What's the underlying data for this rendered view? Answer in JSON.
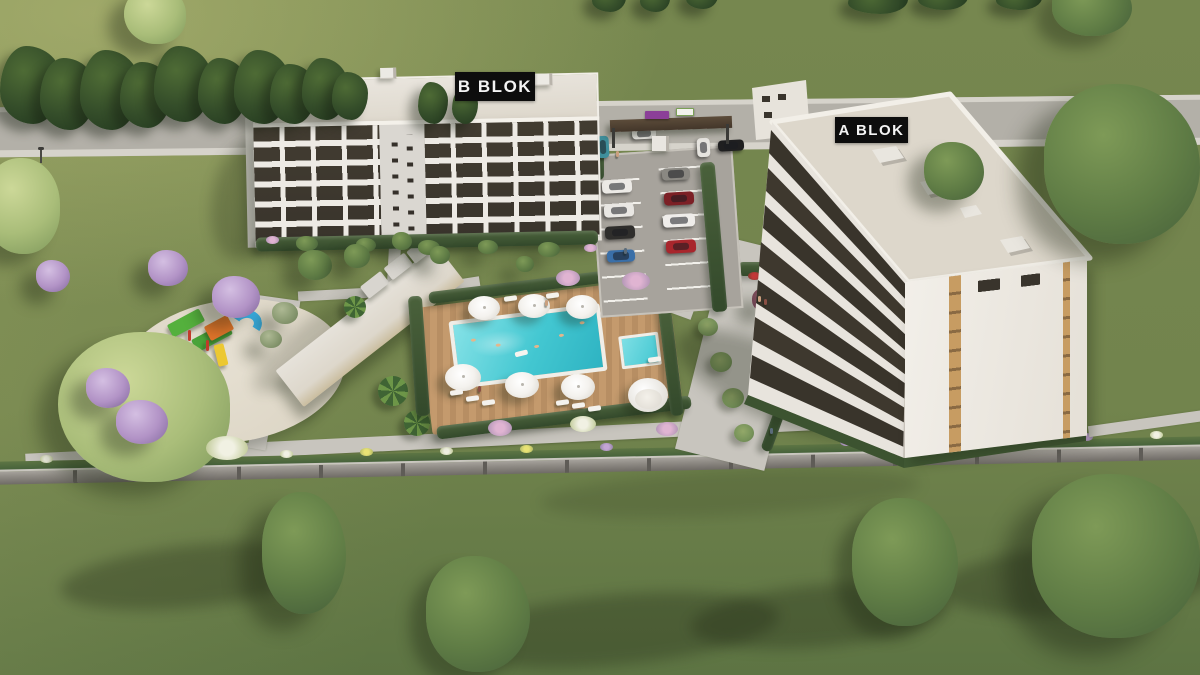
{
  "scene_title": "Aerial 3D architectural render of a residential complex with two apartment blocks, swimming pool, playground and parking",
  "labels": {
    "block_b": "B BLOK",
    "block_a": "A BLOK"
  },
  "palette": {
    "grass-light": "#a8ad6c",
    "grass-main": "#76874f",
    "grass-dark": "#5d7443",
    "road": "#b3b0a8",
    "curb": "#d6d3cb",
    "path": "#c8c5be",
    "deck-wood": "#c49a6d",
    "pool-water": "#43c7d1",
    "building-white": "#edeae4",
    "window-dark": "#39342c",
    "roof-light": "#ddd7cb",
    "sand": "#ddd6c6",
    "hedge": "#3f5531",
    "fence": "#8f8b85",
    "wood-accent": "#c79c62",
    "awning": "#d8d5cf",
    "umbrella": "#f4f2ee",
    "lilac": "#b293c6",
    "label-bg": "#0d0d0d",
    "label-text": "#f4f4f4",
    "gate-sign-purple": "#8b3f98",
    "playground-green": "#54b03d",
    "playground-orange": "#e0742a",
    "playground-blue": "#2e9fd8",
    "playground-yellow": "#ecc832"
  },
  "scene": {
    "buildings": [
      {
        "id": "b-blok",
        "label": "B BLOK",
        "visible_floors": 6
      },
      {
        "id": "a-blok",
        "label": "A BLOK",
        "visible_floors": 7
      }
    ],
    "amenities": [
      "swimming-pool",
      "kids-pool",
      "wood-pool-deck",
      "sun-umbrellas",
      "sun-loungers",
      "shell-cabana",
      "clubhouse",
      "playground",
      "parking-lot",
      "entrance-gate",
      "perimeter-fence",
      "walkways",
      "flower-borders",
      "lawns",
      "trees"
    ],
    "pool": {
      "umbrellas": 6,
      "loungers": 9,
      "swimmers": 5
    },
    "parking": {
      "cars": [
        {
          "name": "white-suv",
          "color": "#eceae6"
        },
        {
          "name": "white-suv-dark-roof",
          "color": "#e9e7e3"
        },
        {
          "name": "black-suv",
          "color": "#2f2e2c"
        },
        {
          "name": "blue-convertible",
          "color": "#3a6fa8"
        },
        {
          "name": "gray-sedan",
          "color": "#8a8882"
        },
        {
          "name": "maroon-sedan",
          "color": "#7c2026"
        },
        {
          "name": "white-suv-2",
          "color": "#efedea"
        },
        {
          "name": "red-sedan",
          "color": "#a8262c"
        },
        {
          "name": "white-car-entrance",
          "color": "#e9e7e2"
        },
        {
          "name": "white-van",
          "color": "#e6e4df"
        },
        {
          "name": "black-sedan-road",
          "color": "#1f1f20"
        },
        {
          "name": "teal-minibus",
          "color": "#3f8f9c"
        }
      ]
    }
  }
}
